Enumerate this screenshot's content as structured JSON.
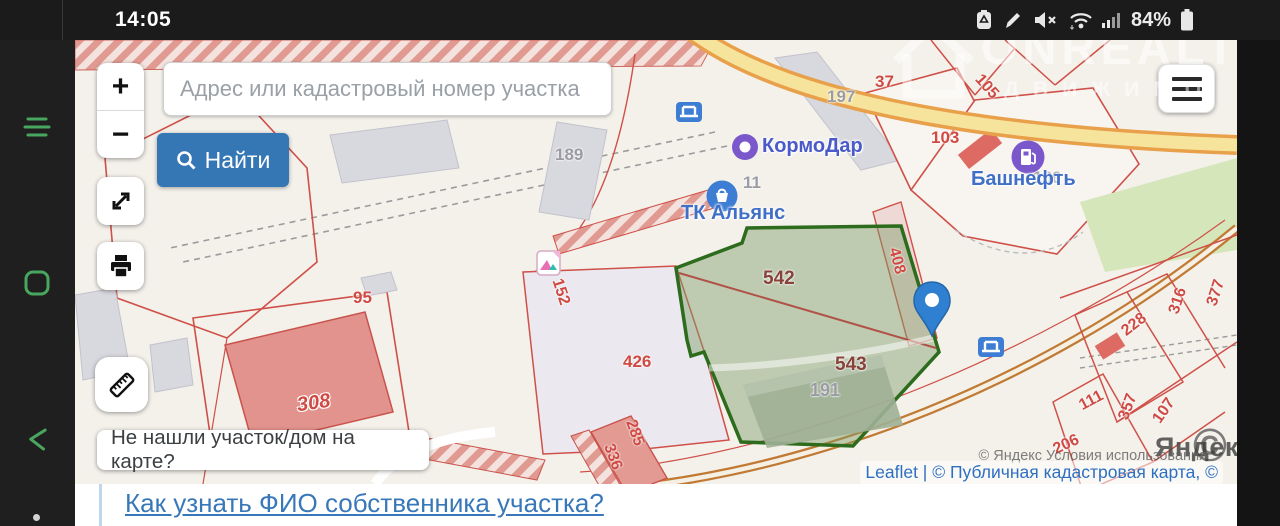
{
  "status_bar": {
    "time": "14:05",
    "battery_percent": "84%"
  },
  "watermark": {
    "title": "ONREALT",
    "subtitle": "ДВИЖИМО"
  },
  "nav_bar": {
    "buttons": [
      "recents",
      "home",
      "back"
    ]
  },
  "map": {
    "search": {
      "placeholder": "Адрес или кадастровый номер участка",
      "find_label": "Найти"
    },
    "zoom": {
      "in": "+",
      "out": "−"
    },
    "help_box": "Не нашли участок/дом на карте?",
    "pois": {
      "kormodar": "КормоДар",
      "tk_alyans": "ТК Альянс",
      "bashneft": "Башнефть"
    },
    "attribution": {
      "leaflet_line": "Leaflet | © Публичная кадастровая карта, ©",
      "yandex_line": "© Яндекс Условия использования",
      "yandex_logo": "Яндекс",
      "copyright": "©"
    },
    "highlighted_parcels": [
      "542",
      "543"
    ],
    "labels": [
      {
        "text": "189",
        "x": 480,
        "y": 105,
        "color": "gray",
        "size": 17
      },
      {
        "text": "197",
        "x": 752,
        "y": 47,
        "color": "gray",
        "size": 17
      },
      {
        "text": "37",
        "x": 800,
        "y": 32,
        "color": "red",
        "size": 17
      },
      {
        "text": "105",
        "x": 898,
        "y": 38,
        "color": "red",
        "size": 16,
        "rot": 48
      },
      {
        "text": "103",
        "x": 856,
        "y": 88,
        "color": "red",
        "size": 17
      },
      {
        "text": "186",
        "x": 958,
        "y": 128,
        "color": "gray",
        "size": 17
      },
      {
        "text": "11",
        "x": 668,
        "y": 133,
        "color": "gray",
        "size": 17
      },
      {
        "text": "95",
        "x": 278,
        "y": 248,
        "color": "red",
        "size": 17
      },
      {
        "text": "308",
        "x": 222,
        "y": 352,
        "color": "red",
        "size": 20,
        "rot": -8,
        "outline": true
      },
      {
        "text": "320",
        "x": 48,
        "y": 415,
        "color": "red",
        "size": 17
      },
      {
        "text": "426",
        "x": 548,
        "y": 312,
        "color": "red",
        "size": 17
      },
      {
        "text": "152",
        "x": 472,
        "y": 243,
        "color": "red",
        "size": 16,
        "rot": 72
      },
      {
        "text": "285",
        "x": 546,
        "y": 384,
        "color": "red",
        "size": 16,
        "rot": 70
      },
      {
        "text": "336",
        "x": 524,
        "y": 408,
        "color": "red",
        "size": 16,
        "rot": 70
      },
      {
        "text": "542",
        "x": 688,
        "y": 228,
        "color": "darkred",
        "size": 19
      },
      {
        "text": "543",
        "x": 760,
        "y": 314,
        "color": "darkred",
        "size": 19
      },
      {
        "text": "191",
        "x": 735,
        "y": 340,
        "color": "gray",
        "size": 18
      },
      {
        "text": "408",
        "x": 808,
        "y": 212,
        "color": "red",
        "size": 16,
        "rot": 75
      },
      {
        "text": "228",
        "x": 1046,
        "y": 276,
        "color": "red",
        "size": 16,
        "rot": -38
      },
      {
        "text": "316",
        "x": 1090,
        "y": 252,
        "color": "red",
        "size": 16,
        "rot": -72
      },
      {
        "text": "377",
        "x": 1128,
        "y": 244,
        "color": "red",
        "size": 16,
        "rot": -72
      },
      {
        "text": "111",
        "x": 1004,
        "y": 352,
        "color": "red",
        "size": 16,
        "rot": -28
      },
      {
        "text": "357",
        "x": 1040,
        "y": 358,
        "color": "red",
        "size": 16,
        "rot": -70
      },
      {
        "text": "107",
        "x": 1076,
        "y": 362,
        "color": "red",
        "size": 16,
        "rot": -55
      },
      {
        "text": "206",
        "x": 978,
        "y": 396,
        "color": "red",
        "size": 16,
        "rot": -25
      }
    ]
  },
  "bottom_link": "Как узнать ФИО собственника участка?",
  "colors": {
    "accent_blue": "#3577b5",
    "parcel_red": "#cf5048",
    "highlight_green_border": "#2d6b1d",
    "highlight_green_fill": "rgba(124,158,104,0.45)",
    "marker_blue": "#2f80d0",
    "nav_green": "#48a65f",
    "road_yellow": "#f7e49c",
    "link_blue": "#3878b8"
  }
}
